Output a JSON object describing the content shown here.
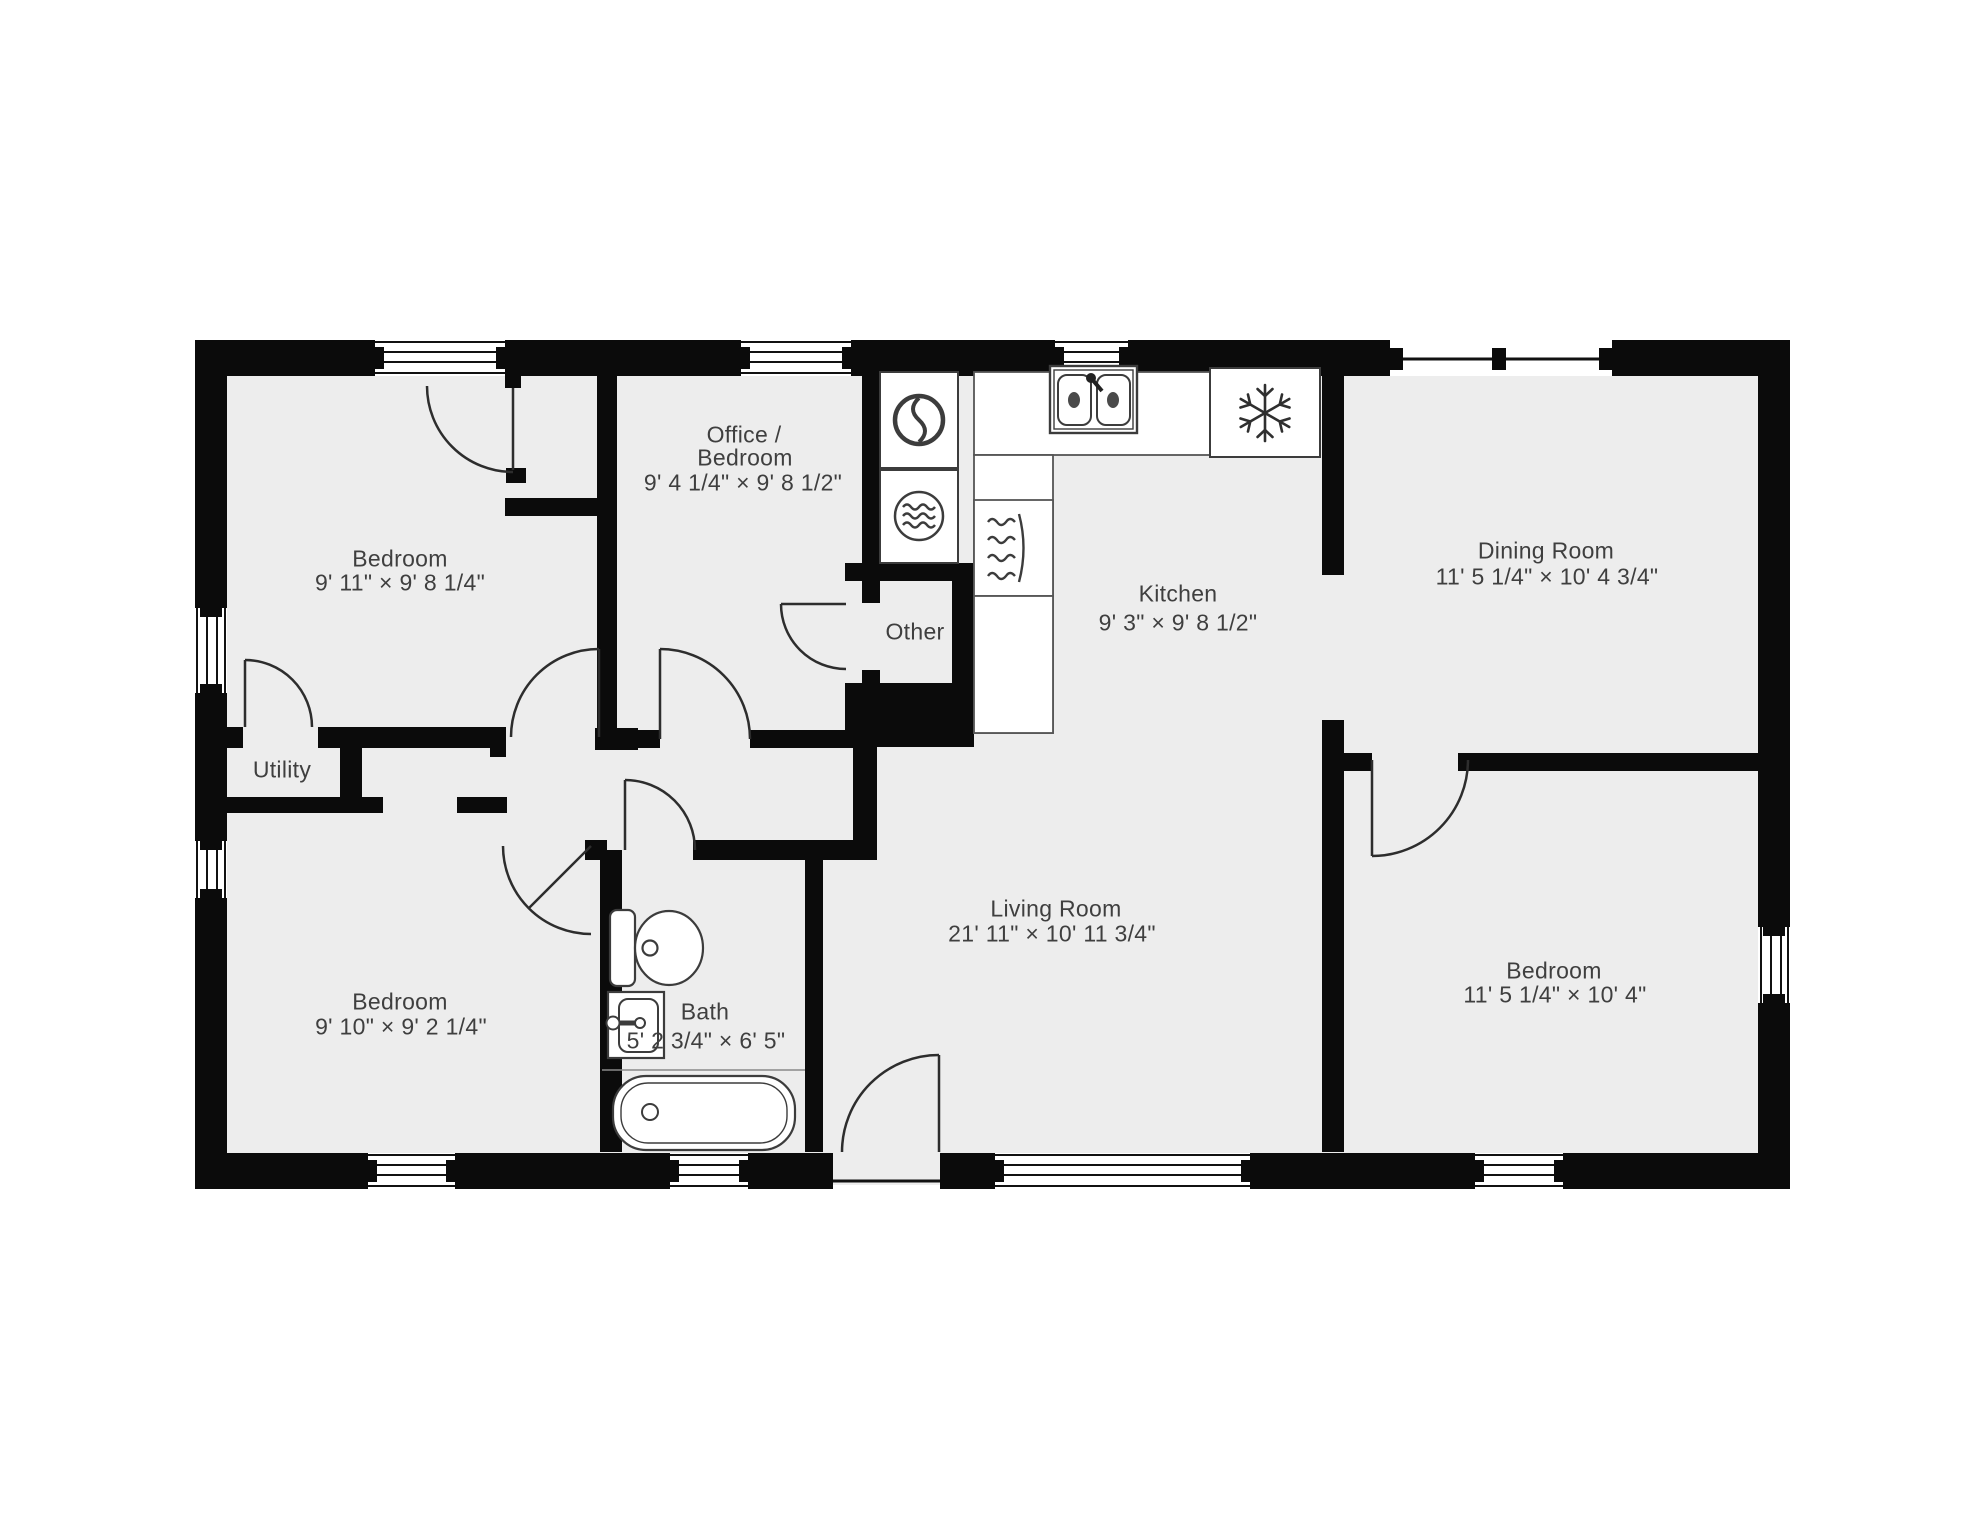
{
  "title": "Floor plan",
  "colors": {
    "background": "#ffffff",
    "floor": "#ededed",
    "wall": "#0b0b0b",
    "label": "#3f3f3f",
    "fixture_outline": "#3c3c3c"
  },
  "rooms": {
    "bedroom_tl": {
      "name": "Bedroom",
      "dims": "9' 11\" × 9' 8 1/4\""
    },
    "office": {
      "name_line1": "Office /",
      "name_line2": "Bedroom",
      "dims": "9' 4 1/4\" × 9' 8 1/2\""
    },
    "kitchen": {
      "name": "Kitchen",
      "dims": "9' 3\" × 9' 8 1/2\""
    },
    "dining": {
      "name": "Dining Room",
      "dims": "11' 5 1/4\" × 10' 4 3/4\""
    },
    "utility": {
      "name": "Utility"
    },
    "other": {
      "name": "Other"
    },
    "bath": {
      "name": "Bath",
      "dims": "5' 2 3/4\" × 6' 5\""
    },
    "living": {
      "name": "Living Room",
      "dims": "21' 11\" × 10' 11 3/4\""
    },
    "bedroom_bl": {
      "name": "Bedroom",
      "dims": "9' 10\" × 9' 2 1/4\""
    },
    "bedroom_br": {
      "name": "Bedroom",
      "dims": "11' 5 1/4\" × 10' 4\""
    }
  },
  "fixtures": [
    "washer",
    "dryer",
    "kitchen-sink",
    "refrigerator",
    "stove",
    "toilet",
    "bathroom-sink",
    "bathtub"
  ]
}
